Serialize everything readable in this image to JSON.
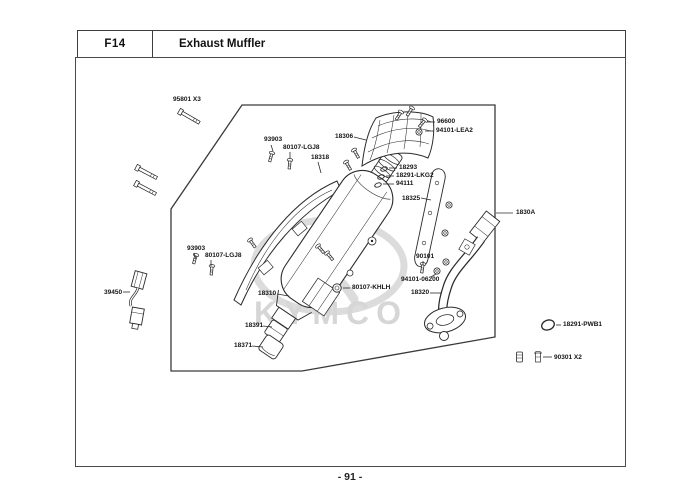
{
  "header": {
    "section_code": "F14",
    "title": "Exhaust Muffler"
  },
  "footer": {
    "page_number": "- 91 -"
  },
  "watermark": {
    "brand": "KYMCO"
  },
  "diagram": {
    "labels": [
      {
        "id": "95801-x3",
        "text": "95801 X3",
        "x": 173,
        "y": 96
      },
      {
        "id": "93903-top",
        "text": "93903",
        "x": 264,
        "y": 136,
        "leader": [
          271,
          145,
          273,
          151
        ]
      },
      {
        "id": "80107-lgj8-top",
        "text": "80107-LGJ8",
        "x": 283,
        "y": 144,
        "leader": [
          290,
          152,
          290,
          158
        ]
      },
      {
        "id": "18318",
        "text": "18318",
        "x": 311,
        "y": 154,
        "leader": [
          318,
          162,
          321,
          173
        ]
      },
      {
        "id": "18306",
        "text": "18306",
        "x": 335,
        "y": 133,
        "leader": [
          354,
          137,
          366,
          140
        ]
      },
      {
        "id": "96600",
        "text": "96600",
        "x": 437,
        "y": 118,
        "leader": [
          427,
          122,
          435,
          122
        ]
      },
      {
        "id": "94101-lea2",
        "text": "94101-LEA2",
        "x": 436,
        "y": 127,
        "leader": [
          425,
          131,
          434,
          131
        ]
      },
      {
        "id": "18293",
        "text": "18293",
        "x": 399,
        "y": 164,
        "leader": [
          389,
          168,
          397,
          168
        ]
      },
      {
        "id": "18291-lkg2",
        "text": "18291-LKG2",
        "x": 396,
        "y": 172,
        "leader": [
          386,
          176,
          394,
          176
        ]
      },
      {
        "id": "94111",
        "text": "94111",
        "x": 396,
        "y": 180,
        "leader": [
          383,
          184,
          394,
          184
        ]
      },
      {
        "id": "18325",
        "text": "18325",
        "x": 402,
        "y": 195,
        "leader": [
          421,
          198,
          431,
          200
        ]
      },
      {
        "id": "1830a",
        "text": "1830A",
        "x": 516,
        "y": 209,
        "leader": [
          496,
          213,
          513,
          213
        ]
      },
      {
        "id": "93903-left",
        "text": "93903",
        "x": 187,
        "y": 245,
        "leader": [
          194,
          253,
          196,
          259
        ]
      },
      {
        "id": "80107-lgj8-left",
        "text": "80107-LGJ8",
        "x": 205,
        "y": 252,
        "leader": [
          211,
          260,
          211,
          266
        ]
      },
      {
        "id": "39450",
        "text": "39450",
        "x": 104,
        "y": 289,
        "leader": [
          123,
          292,
          130,
          292
        ]
      },
      {
        "id": "18310",
        "text": "18310",
        "x": 258,
        "y": 290,
        "leader": [
          277,
          294,
          289,
          296
        ]
      },
      {
        "id": "80107-khlh",
        "text": "80107-KHLH",
        "x": 352,
        "y": 284,
        "leader": [
          343,
          288,
          350,
          288
        ]
      },
      {
        "id": "90101",
        "text": "90101",
        "x": 416,
        "y": 253,
        "leader": [
          423,
          261,
          423,
          265
        ]
      },
      {
        "id": "94101-06200",
        "text": "94101-06200",
        "x": 401,
        "y": 276,
        "leader": [
          436,
          274,
          431,
          277
        ]
      },
      {
        "id": "18320",
        "text": "18320",
        "x": 411,
        "y": 289,
        "leader": [
          430,
          293,
          442,
          293
        ]
      },
      {
        "id": "18391",
        "text": "18391",
        "x": 245,
        "y": 322,
        "leader": [
          263,
          326,
          272,
          327
        ]
      },
      {
        "id": "18371",
        "text": "18371",
        "x": 234,
        "y": 342,
        "leader": [
          252,
          346,
          263,
          347
        ]
      },
      {
        "id": "18291-pwb1",
        "text": "18291-PWB1",
        "x": 563,
        "y": 321,
        "leader": [
          556,
          325,
          561,
          325
        ]
      },
      {
        "id": "90301-x2",
        "text": "90301 X2",
        "x": 554,
        "y": 354,
        "leader": [
          543,
          357,
          552,
          357
        ]
      }
    ]
  }
}
